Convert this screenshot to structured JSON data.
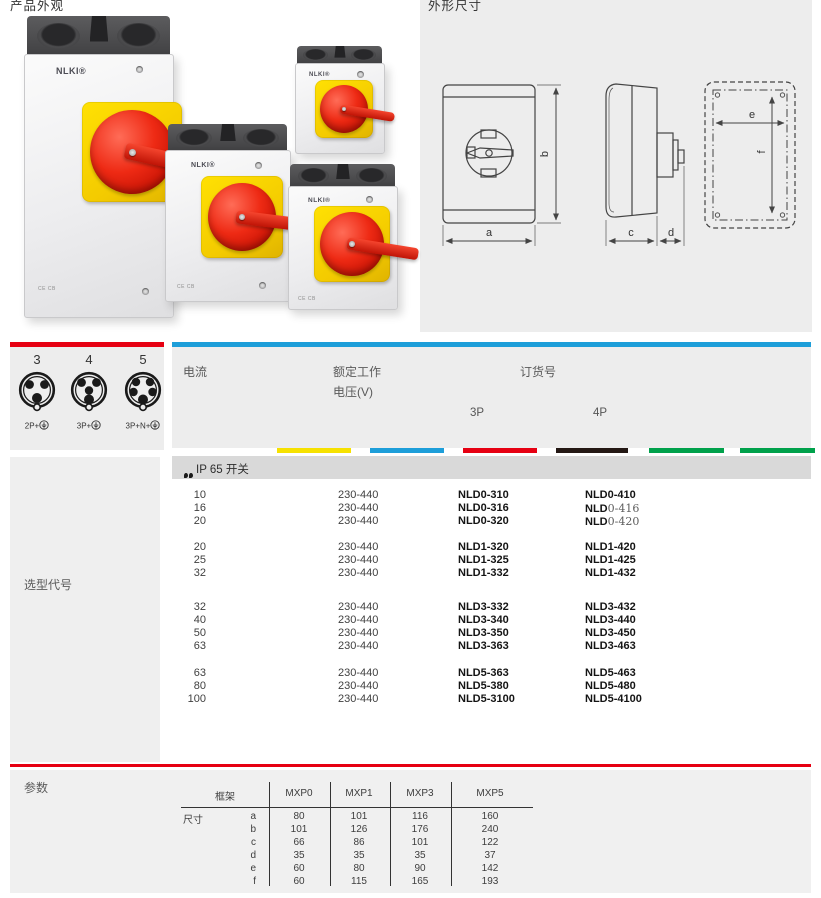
{
  "titles": {
    "left": "产品外观",
    "right": "外形尺寸"
  },
  "product": {
    "brand": "NLKI®",
    "cert": "CE CB"
  },
  "dims": {
    "a": "a",
    "b": "b",
    "c": "c",
    "d": "d",
    "e": "e",
    "f": "f"
  },
  "connectors": {
    "items": [
      {
        "pins": "3",
        "label": "2P+",
        "earth": true
      },
      {
        "pins": "4",
        "label": "3P+",
        "earth": true
      },
      {
        "pins": "5",
        "label": "3P+N+",
        "earth": true
      }
    ]
  },
  "selection": {
    "sidebar_label": "选型代号",
    "header": {
      "current": "电流",
      "voltage_line1": "额定工作",
      "voltage_line2": "电压(V)",
      "order_no": "订货号",
      "col_3p": "3P",
      "col_4p": "4P"
    },
    "section_label": "IP 65 开关",
    "color_strip": [
      "#f6e100",
      "#1d9ed9",
      "#e60012",
      "#241814",
      "#00a14b",
      "#00a14b"
    ],
    "accent": {
      "red": "#e60012",
      "blue": "#1d9ed9"
    },
    "groups": [
      {
        "rows": [
          {
            "current": "10",
            "voltage": "230-440",
            "p3": "NLD0-310",
            "p4": "NLD0-410"
          },
          {
            "current": "16",
            "voltage": "230-440",
            "p3": "NLD0-316",
            "p4": "NLD0-416",
            "p4_light": true
          },
          {
            "current": "20",
            "voltage": "230-440",
            "p3": "NLD0-320",
            "p4": "NLD0-420",
            "p4_light": true
          }
        ]
      },
      {
        "rows": [
          {
            "current": "20",
            "voltage": "230-440",
            "p3": "NLD1-320",
            "p4": "NLD1-420"
          },
          {
            "current": "25",
            "voltage": "230-440",
            "p3": "NLD1-325",
            "p4": "NLD1-425"
          },
          {
            "current": "32",
            "voltage": "230-440",
            "p3": "NLD1-332",
            "p4": "NLD1-432"
          }
        ]
      },
      {
        "rows": [
          {
            "current": "32",
            "voltage": "230-440",
            "p3": "NLD3-332",
            "p4": "NLD3-432"
          },
          {
            "current": "40",
            "voltage": "230-440",
            "p3": "NLD3-340",
            "p4": "NLD3-440"
          },
          {
            "current": "50",
            "voltage": "230-440",
            "p3": "NLD3-350",
            "p4": "NLD3-450"
          },
          {
            "current": "63",
            "voltage": "230-440",
            "p3": "NLD3-363",
            "p4": "NLD3-463"
          }
        ]
      },
      {
        "rows": [
          {
            "current": "63",
            "voltage": "230-440",
            "p3": "NLD5-363",
            "p4": "NLD5-463"
          },
          {
            "current": "80",
            "voltage": "230-440",
            "p3": "NLD5-380",
            "p4": "NLD5-480"
          },
          {
            "current": "100",
            "voltage": "230-440",
            "p3": "NLD5-3100",
            "p4": "NLD5-4100"
          }
        ]
      }
    ]
  },
  "params": {
    "title": "参数",
    "frame_label": "框架",
    "size_label": "尺寸",
    "columns": [
      "MXP0",
      "MXP1",
      "MXP3",
      "MXP5"
    ],
    "rows": [
      {
        "dim": "a",
        "values": [
          "80",
          "101",
          "116",
          "160"
        ]
      },
      {
        "dim": "b",
        "values": [
          "101",
          "126",
          "176",
          "240"
        ]
      },
      {
        "dim": "c",
        "values": [
          "66",
          "86",
          "101",
          "122"
        ]
      },
      {
        "dim": "d",
        "values": [
          "35",
          "35",
          "35",
          "37"
        ]
      },
      {
        "dim": "e",
        "values": [
          "60",
          "80",
          "90",
          "142"
        ]
      },
      {
        "dim": "f",
        "values": [
          "60",
          "115",
          "165",
          "193"
        ]
      }
    ]
  }
}
